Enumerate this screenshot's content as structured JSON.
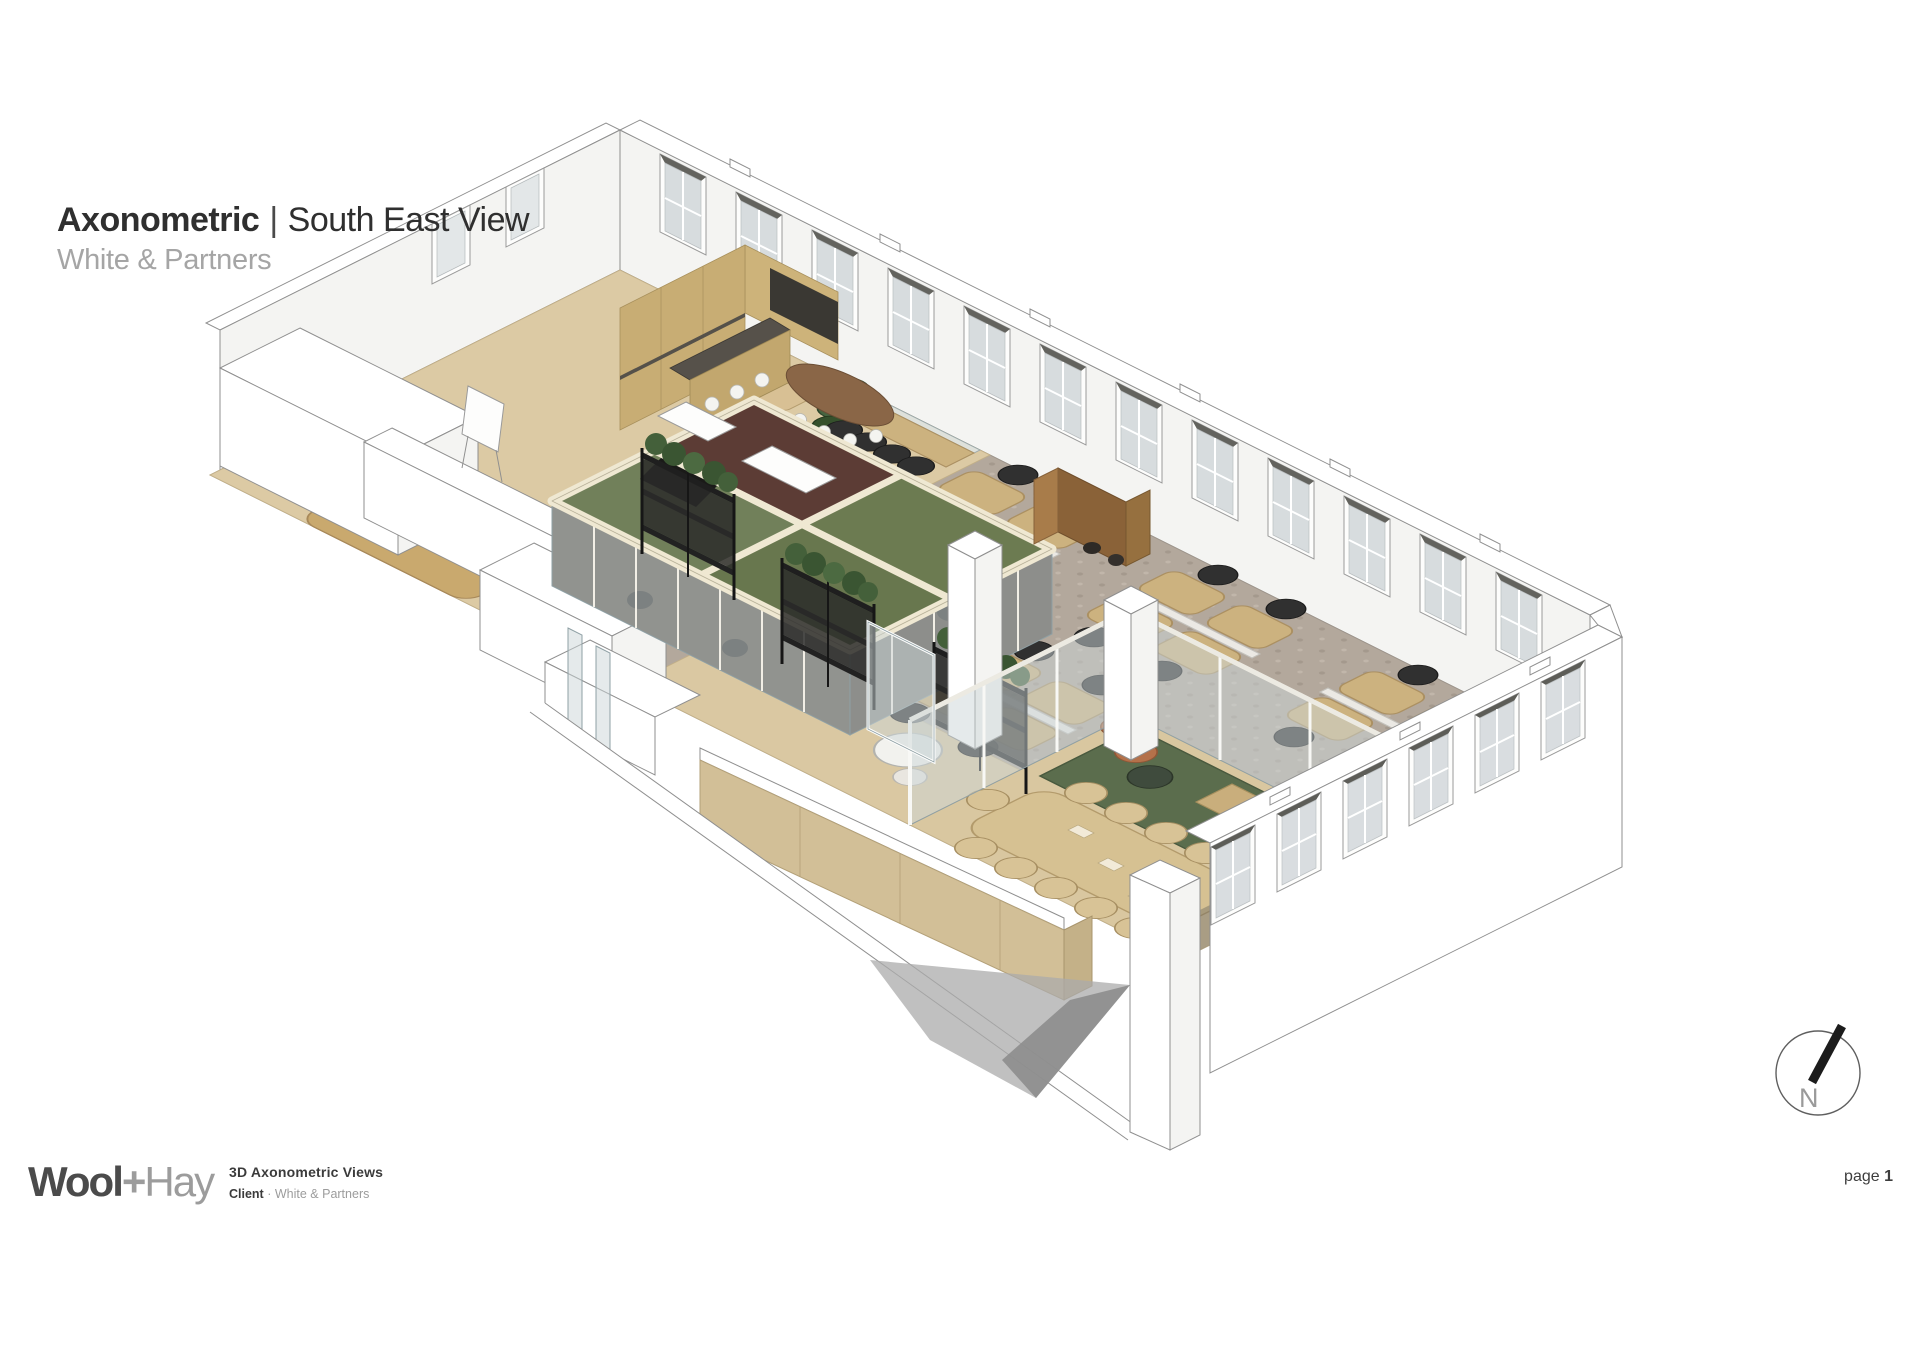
{
  "header": {
    "title": "Axonometric",
    "divider": "|",
    "view_name": "South East View",
    "client": "White & Partners"
  },
  "footer": {
    "logo_primary": "Wool",
    "logo_plus": "+",
    "logo_secondary": "Hay",
    "document_title": "3D Axonometric Views",
    "client_label": "Client",
    "client_separator": "·",
    "client_name": "White & Partners",
    "page_label": "page",
    "page_number": "1"
  },
  "compass": {
    "north_label": "N"
  },
  "drawing": {
    "description": "3D axonometric cutaway of the White & Partners office floor viewed from the south east: kitchen and dining at the north corner, curved glass meeting pods with green and maroon felt roofs, open-plan desk clusters along the window walls, planter shelves, phone booth, reception lounge and a boardroom with green rug at the south corner",
    "areas": [
      "kitchen",
      "dining",
      "banquette-lounge",
      "meeting-pods",
      "open-office-desks",
      "phone-booth",
      "planter-shelves",
      "reception",
      "boardroom",
      "building-core"
    ],
    "colors": {
      "carpet": "#b3a89c",
      "timber_floor": "#dccaa4",
      "desk_top": "#ccb27f",
      "joinery_tan": "#c8ad74",
      "pod_roof_green": "#6c7b51",
      "pod_roof_maroon": "#5c3c35",
      "boardroom_rug": "#5b6d4d",
      "task_chair_black": "#303030",
      "glass": "#d7dcde",
      "wall_white": "#ffffff"
    }
  }
}
